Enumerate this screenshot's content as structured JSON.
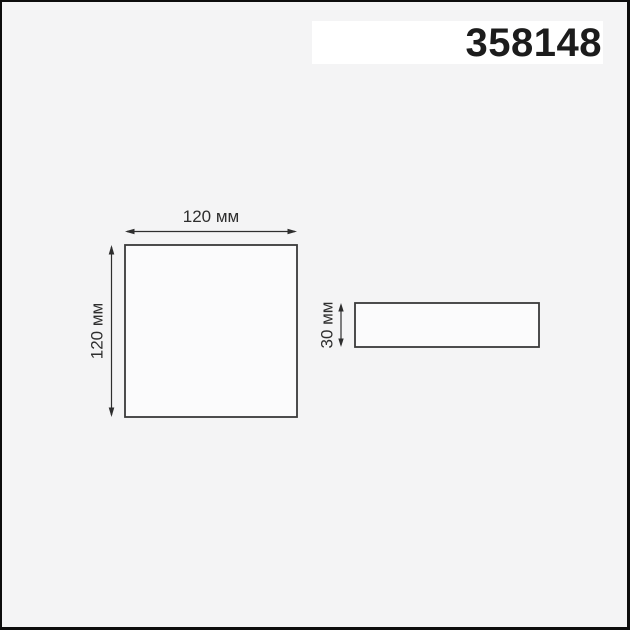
{
  "header": {
    "product_code": "358148"
  },
  "diagram": {
    "front_view": {
      "width_label": "120 мм",
      "height_label": "120 мм"
    },
    "side_view": {
      "height_label": "30 мм"
    }
  },
  "colors": {
    "background": "#f4f4f5",
    "frame_border": "#0d0d0d",
    "outline_line": "#3a3a3a",
    "dimension_line": "#2e2e2e",
    "title_text": "#1c1c1c",
    "panel_fill": "#fbfbfc",
    "title_panel_fill": "#ffffff"
  }
}
